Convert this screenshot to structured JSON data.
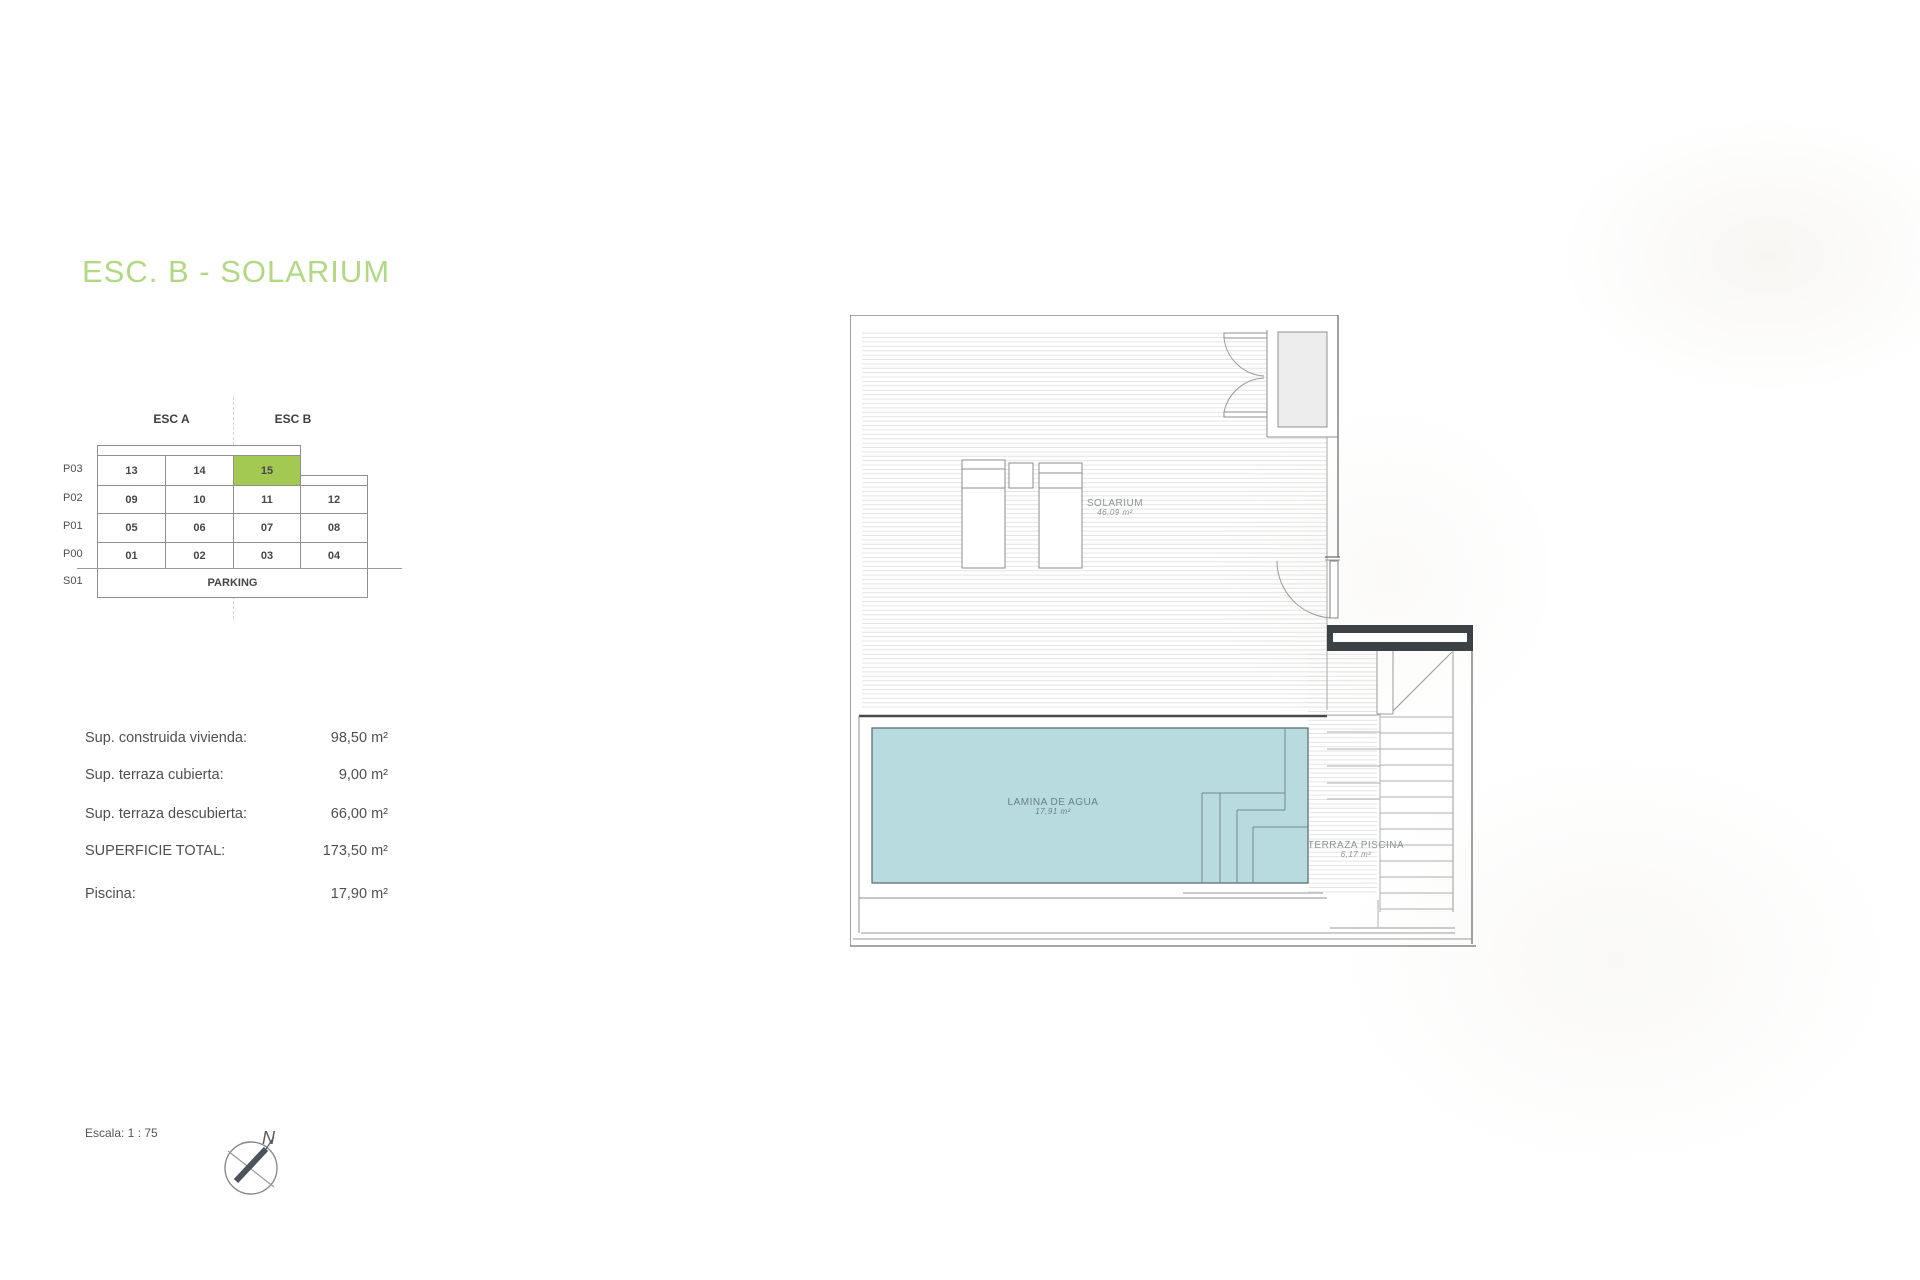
{
  "title": {
    "text": "ESC. B - SOLARIUM",
    "color": "#b1d883"
  },
  "unit_matrix": {
    "section_headers": [
      "ESC A",
      "ESC B"
    ],
    "floors": [
      {
        "label": "P03",
        "cells": [
          "13",
          "14",
          "15"
        ]
      },
      {
        "label": "P02",
        "cells": [
          "09",
          "10",
          "11",
          "12"
        ]
      },
      {
        "label": "P01",
        "cells": [
          "05",
          "06",
          "07",
          "08"
        ]
      },
      {
        "label": "P00",
        "cells": [
          "01",
          "02",
          "03",
          "04"
        ]
      },
      {
        "label": "S01",
        "cells": [
          "PARKING"
        ]
      }
    ],
    "highlighted_unit": "15",
    "highlight_color": "#a3c952"
  },
  "measurements": {
    "rows": [
      {
        "label": "Sup. construida vivienda:",
        "value": "98,50 m²"
      },
      {
        "label": "Sup. terraza cubierta:",
        "value": "9,00 m²"
      },
      {
        "label": "Sup. terraza descubierta:",
        "value": "66,00 m²"
      },
      {
        "label": "SUPERFICIE TOTAL:",
        "value": "173,50 m²"
      },
      {
        "label": "Piscina:",
        "value": "17,90 m²"
      }
    ]
  },
  "floor_plan": {
    "solarium": {
      "name": "SOLARIUM",
      "area": "46,09 m²"
    },
    "pool": {
      "name": "LAMINA DE AGUA",
      "area": "17,91 m²"
    },
    "pool_terrace": {
      "name": "TERRAZA PISCINA",
      "area": "6,17 m²"
    },
    "pool_color": "#b7dbdf"
  },
  "footer": {
    "scale_label": "Escala: 1 : 75",
    "compass_north": "N"
  }
}
